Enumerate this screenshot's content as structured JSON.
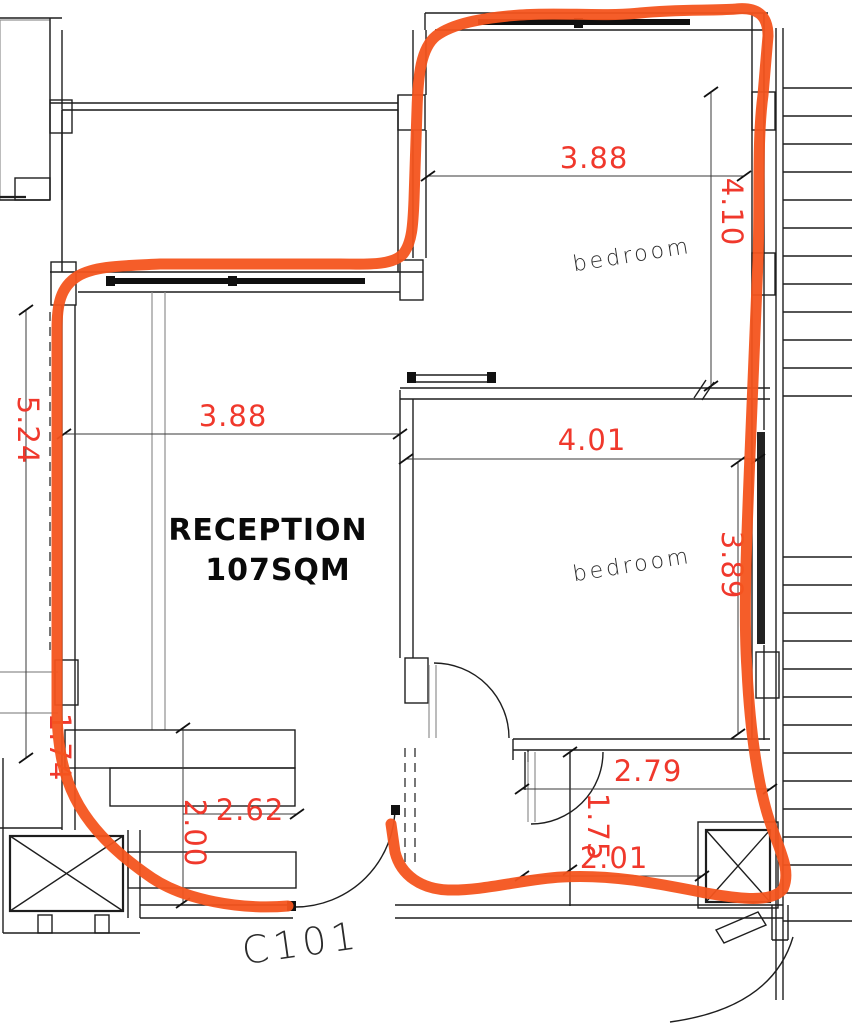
{
  "title": "apartment floor plan sketch with highlighted unit",
  "unit_label": "C101",
  "reception": {
    "name": "RECEPTION",
    "area": "107SQM"
  },
  "rooms": {
    "bedroom_top": "bedroom",
    "bedroom_bottom": "bedroom"
  },
  "dimensions": {
    "bedroom_top_width": "3.88",
    "bedroom_top_depth": "4.10",
    "reception_width": "3.88",
    "reception_depth": "5.24",
    "bedroom_bottom_width": "4.01",
    "bedroom_bottom_depth": "3.89",
    "closet_width": "2.79",
    "hall_depth": "1.75",
    "hall_width": "2.01",
    "kitchen_width": "2.62",
    "kitchen_depth": "2.00",
    "left_partial": "1.74",
    "edge_partial": "0"
  },
  "colors": {
    "highlight_orange": "#f4541d",
    "dimension_red": "#f0382c",
    "line_black": "#1e1e1e"
  }
}
